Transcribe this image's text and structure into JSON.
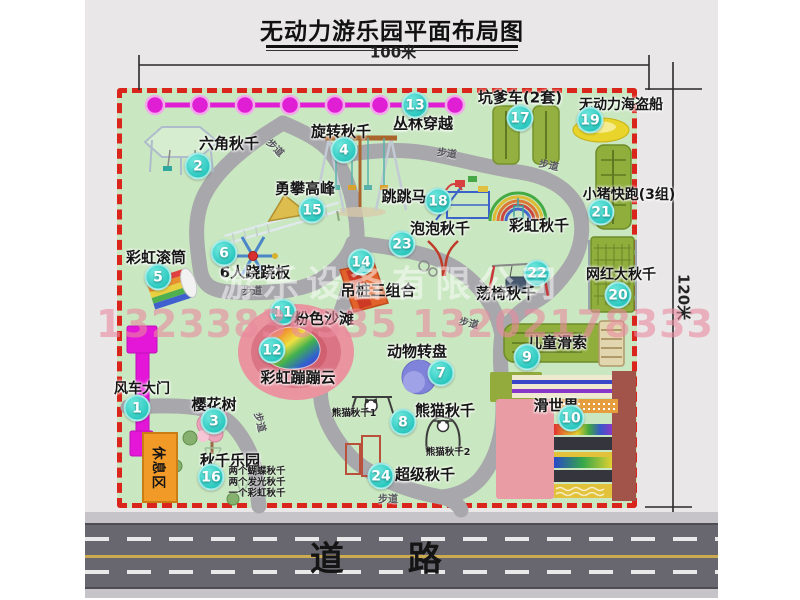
{
  "title": "无动力游乐园平面布局图",
  "dimensions": {
    "width_label": "100米",
    "height_label": "120米"
  },
  "road": {
    "label": "道 路"
  },
  "watermark": {
    "company": "游乐设备有限公司",
    "phone": "13233836335 13202178333"
  },
  "rest_area": {
    "label": "休息区"
  },
  "walkway_label": "步道",
  "rainbow_swing_label": "彩虹秋千",
  "colors": {
    "map_green": "#c9e7c0",
    "border_red": "#da251c",
    "walkway_gray": "#a8a7ac",
    "badge_cyan": "#2cc9c0",
    "gate_magenta": "#e416d8",
    "zipline_magenta": "#e01fd4",
    "rest_orange": "#f29a28",
    "road_gray": "#68666e"
  },
  "attractions": [
    {
      "id": 1,
      "label": "风车大门"
    },
    {
      "id": 2,
      "label": "六角秋千"
    },
    {
      "id": 3,
      "label": "樱花树"
    },
    {
      "id": 4,
      "label": "旋转秋千"
    },
    {
      "id": 5,
      "label": "彩虹滚筒"
    },
    {
      "id": 6,
      "label": "6人跷跷板"
    },
    {
      "id": 7,
      "label": "动物转盘"
    },
    {
      "id": 8,
      "label": "熊猫秋千",
      "sublabels": [
        "熊猫秋千1",
        "熊猫秋千2"
      ]
    },
    {
      "id": 9,
      "label": "儿童滑索"
    },
    {
      "id": 10,
      "label": "滑世界"
    },
    {
      "id": 11,
      "label": "粉色沙滩"
    },
    {
      "id": 12,
      "label": "彩虹蹦蹦云"
    },
    {
      "id": 13,
      "label": "丛林穿越"
    },
    {
      "id": 14,
      "label": "吊桩三组合"
    },
    {
      "id": 15,
      "label": "勇攀高峰"
    },
    {
      "id": 16,
      "label": "秋千乐园",
      "sublabels": [
        "两个蝴蝶秋千",
        "两个发光秋千",
        "一个彩虹秋千"
      ]
    },
    {
      "id": 17,
      "label": "坑爹车(2套)"
    },
    {
      "id": 18,
      "label": "跳跳马"
    },
    {
      "id": 19,
      "label": "无动力海盗船"
    },
    {
      "id": 20,
      "label": "网红大秋千"
    },
    {
      "id": 21,
      "label": "小猪快跑(3组)"
    },
    {
      "id": 22,
      "label": "荡椅秋千"
    },
    {
      "id": 23,
      "label": "泡泡秋千"
    },
    {
      "id": 24,
      "label": "超级秋千"
    }
  ]
}
